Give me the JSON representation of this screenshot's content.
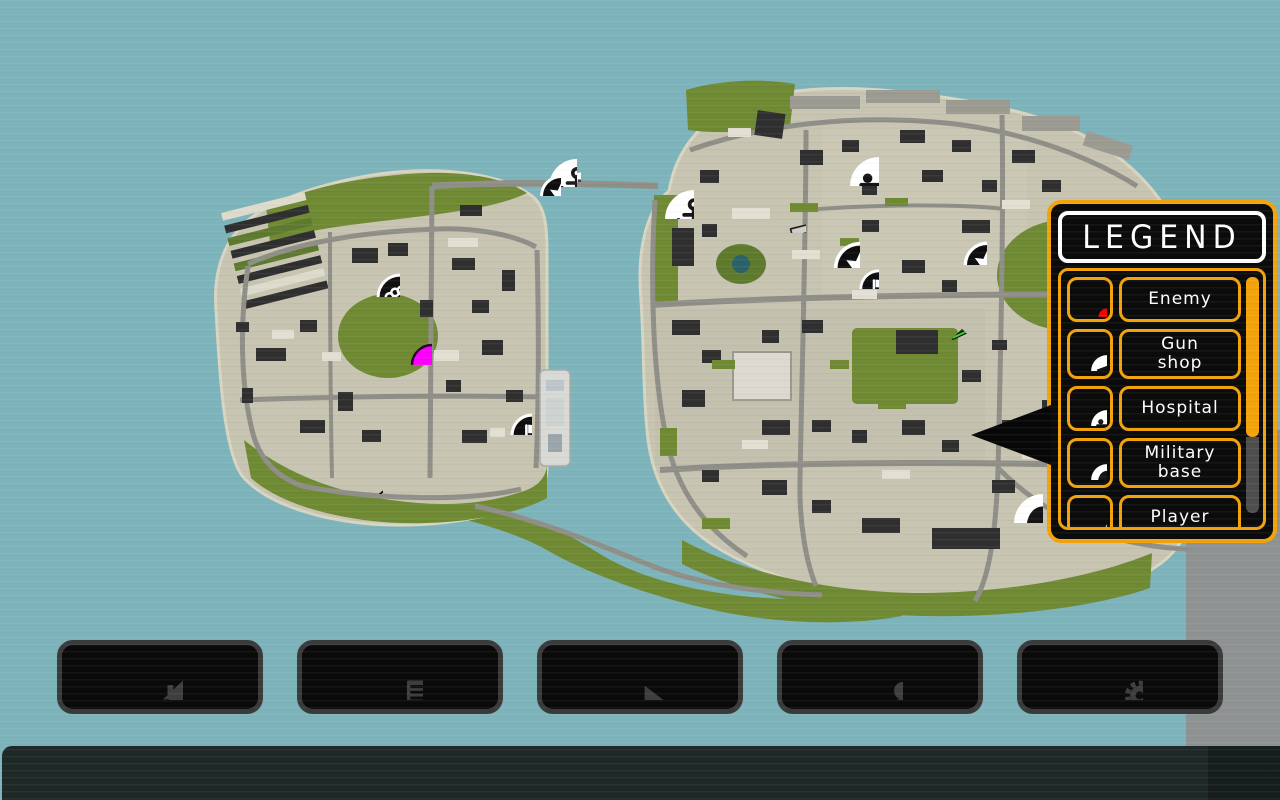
{
  "legend": {
    "title": "LEGEND",
    "accent_color": "#F2A30B",
    "enemy_color": "#EF0508",
    "items": [
      {
        "icon": "enemy-dot",
        "label": "Enemy"
      },
      {
        "icon": "gun-badge",
        "label": "Gun\nshop"
      },
      {
        "icon": "hospital-badge",
        "label": "Hospital"
      },
      {
        "icon": "helmet-badge",
        "label": "Military\nbase"
      },
      {
        "icon": "player-arrow-outline",
        "label": "Player"
      }
    ]
  },
  "map": {
    "colors": {
      "water": "#7DB4BB",
      "grass": "#6F8A33",
      "ground": "#C7C4B1",
      "destination": "#FB00FB",
      "player_green": "#35D42C"
    },
    "markers": [
      {
        "name": "brass-knuckles-marker",
        "kind": "knuckles",
        "x": 375,
        "y": 272,
        "size": 50
      },
      {
        "name": "destination-marker",
        "kind": "magenta-dot",
        "x": 408,
        "y": 341,
        "size": 48
      },
      {
        "name": "harbor-small-marker",
        "kind": "small-dot",
        "x": 570,
        "y": 171,
        "size": 22
      },
      {
        "name": "harbor-anchor-marker",
        "kind": "anchor-badge",
        "x": 547,
        "y": 157,
        "size": 60
      },
      {
        "name": "police-star-marker-1",
        "kind": "star-badge",
        "x": 538,
        "y": 173,
        "size": 45
      },
      {
        "name": "dock-anchor-marker",
        "kind": "anchor-badge",
        "x": 663,
        "y": 188,
        "size": 62
      },
      {
        "name": "pistol-pickup-marker",
        "kind": "pistol",
        "x": 785,
        "y": 212,
        "size": 42
      },
      {
        "name": "hospital-marker",
        "kind": "hospital-badge",
        "x": 848,
        "y": 155,
        "size": 62
      },
      {
        "name": "police-star-marker-2",
        "kind": "star-badge",
        "x": 832,
        "y": 240,
        "size": 56
      },
      {
        "name": "flag-marker-2",
        "kind": "flag-badge",
        "x": 858,
        "y": 268,
        "size": 42
      },
      {
        "name": "police-star-marker-3",
        "kind": "star-badge",
        "x": 962,
        "y": 240,
        "size": 50
      },
      {
        "name": "player-marker",
        "kind": "player-arrow",
        "x": 962,
        "y": 357,
        "size": 40,
        "rotate": 225
      },
      {
        "name": "flag-marker-1",
        "kind": "flag-badge",
        "x": 509,
        "y": 412,
        "size": 46
      },
      {
        "name": "bat-pickup-marker",
        "kind": "bat",
        "x": 360,
        "y": 471,
        "size": 46
      },
      {
        "name": "military-helmet-marker",
        "kind": "helmet-badge",
        "x": 1012,
        "y": 492,
        "size": 62
      }
    ]
  },
  "toolbar": {
    "buttons": [
      {
        "name": "home-button",
        "icon": "home-icon"
      },
      {
        "name": "quests-button",
        "icon": "document-check-icon"
      },
      {
        "name": "play-pause-button",
        "icon": "play-pause-icon"
      },
      {
        "name": "profile-button",
        "icon": "person-icon"
      },
      {
        "name": "settings-button",
        "icon": "gears-icon"
      }
    ]
  }
}
